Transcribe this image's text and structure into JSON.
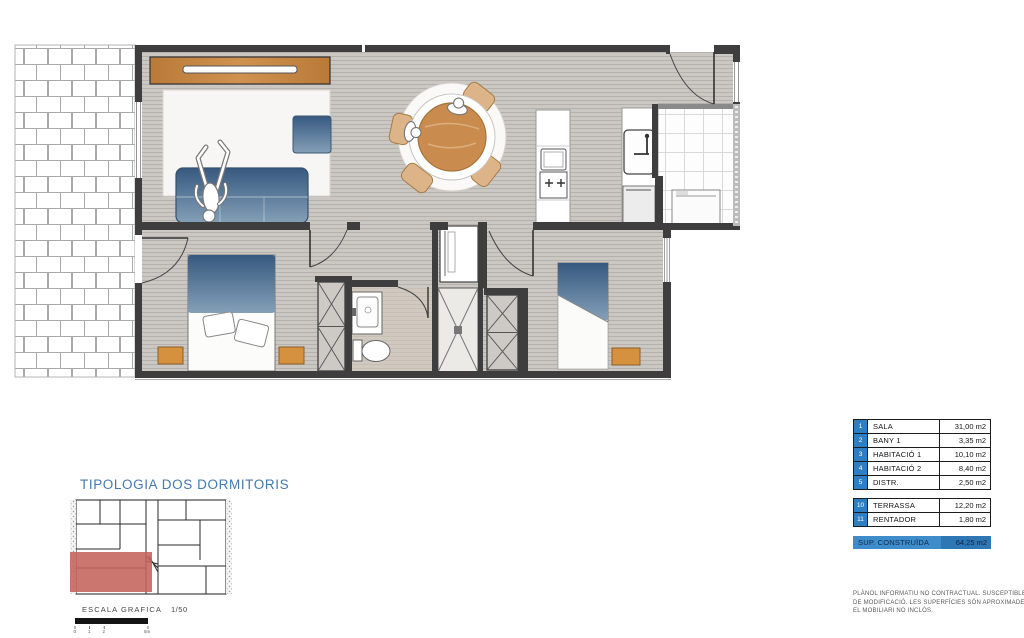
{
  "title": "TIPOLOGIA DOS DORMITORIS",
  "scale": {
    "label": "ESCALA GRAFICA",
    "ratio": "1/50",
    "ticks": [
      "0",
      "1",
      "2",
      "5m"
    ]
  },
  "legend": {
    "main_rooms": [
      {
        "num": "1",
        "name": "SALA",
        "area": "31,00 m2"
      },
      {
        "num": "2",
        "name": "BANY 1",
        "area": "3,35 m2"
      },
      {
        "num": "3",
        "name": "HABITACIÓ 1",
        "area": "10,10 m2"
      },
      {
        "num": "4",
        "name": "HABITACIÓ 2",
        "area": "8,40 m2"
      },
      {
        "num": "5",
        "name": "DISTR.",
        "area": "2,50 m2"
      }
    ],
    "extra_rooms": [
      {
        "num": "10",
        "name": "TERRASSA",
        "area": "12,20 m2"
      },
      {
        "num": "11",
        "name": "RENTADOR",
        "area": "1,80 m2"
      }
    ],
    "total": {
      "label": "SUP. CONSTRUÏDA",
      "area": "64,25 m2"
    }
  },
  "disclaimer": [
    "PLÀNOL INFORMATIU NO CONTRACTUAL. SUSCEPTIBLE",
    "DE MODIFICACIÓ. LES SUPERFÍCIES SÓN APROXIMADES.",
    "EL MOBILIARI NO INCLÒS."
  ],
  "colors": {
    "accent_blue": "#2e7fc1",
    "total_bar": "#3f8ccb",
    "total_value": "#2e76b4",
    "highlight_red": "#c4635b",
    "title_blue": "#4679ae"
  }
}
